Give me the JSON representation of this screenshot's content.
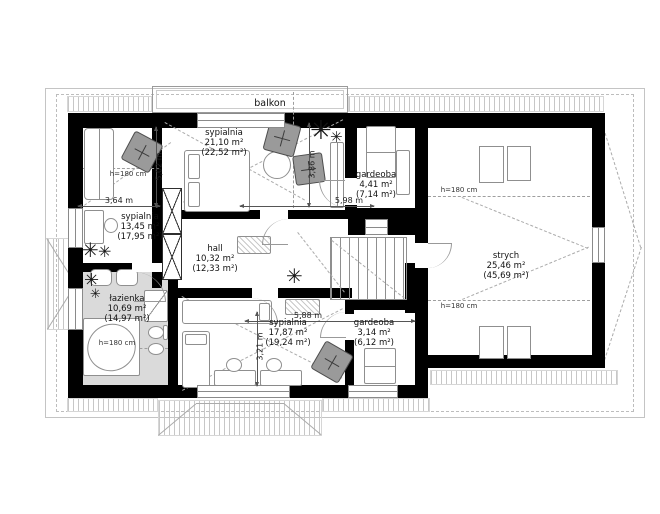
{
  "labels": {
    "balcony": "balkon"
  },
  "rooms": [
    {
      "id": "sypialnia-21",
      "name": "sypialnia",
      "area": "21,10 m²",
      "area_total": "(22,52 m²)"
    },
    {
      "id": "gardeoba-441",
      "name": "gardeoba",
      "area": "4,41 m²",
      "area_total": "(7,14 m²)"
    },
    {
      "id": "sypialnia-13",
      "name": "sypialnia",
      "area": "13,45 m²",
      "area_total": "(17,95 m²)"
    },
    {
      "id": "hall",
      "name": "hall",
      "area": "10,32 m²",
      "area_total": "(12,33 m²)"
    },
    {
      "id": "lazienka",
      "name": "łazienka",
      "area": "10,69 m²",
      "area_total": "(14,97 m²)"
    },
    {
      "id": "sypialnia-17",
      "name": "sypialnia",
      "area": "17,87 m²",
      "area_total": "(19,24 m²)"
    },
    {
      "id": "gardeoba-314",
      "name": "gardeoba",
      "area": "3,14 m²",
      "area_total": "(6,12 m²)"
    },
    {
      "id": "strych",
      "name": "strych",
      "area": "25,46 m²",
      "area_total": "(45,69 m²)"
    }
  ],
  "dimensions": [
    {
      "id": "dim-3-64",
      "label": "3,64 m"
    },
    {
      "id": "dim-5-02",
      "label": "5,02 m"
    },
    {
      "id": "dim-3-86",
      "label": "3,86 m"
    },
    {
      "id": "dim-5-98",
      "label": "5,98 m"
    },
    {
      "id": "dim-5-88",
      "label": "5,88 m"
    },
    {
      "id": "dim-3-21",
      "label": "3,21 m"
    }
  ],
  "height_note": "h=180 cm",
  "plant_glyph": "✳",
  "colors": {
    "wall": "#000000",
    "bathroom_floor": "#dadada",
    "furniture_dark": "#9a9a9a",
    "hatch": "#c7c7c7"
  }
}
